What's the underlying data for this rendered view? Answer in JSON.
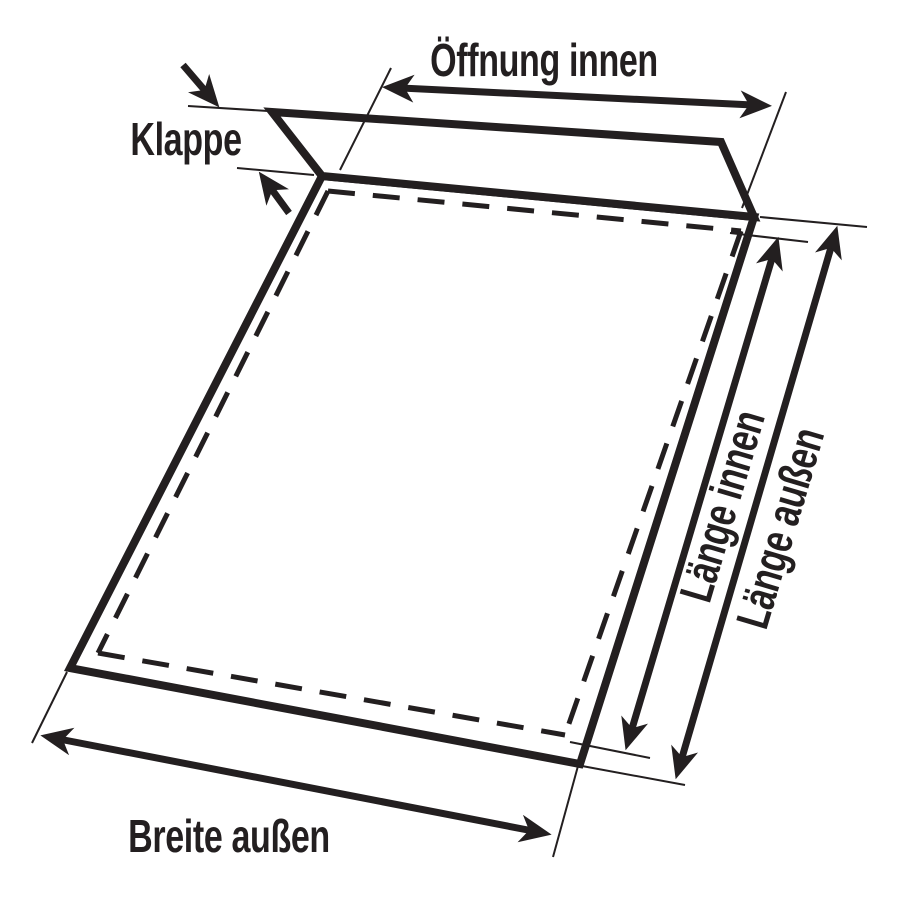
{
  "diagram": {
    "subject": "envelope-dimensions",
    "labels": {
      "oeffnung_innen": "Öffnung innen",
      "klappe": "Klappe",
      "laenge_innen": "Länge innen",
      "laenge_aussen": "Länge außen",
      "breite_aussen": "Breite außen"
    }
  },
  "colors": {
    "ink": "#231f20",
    "background": "#ffffff"
  }
}
